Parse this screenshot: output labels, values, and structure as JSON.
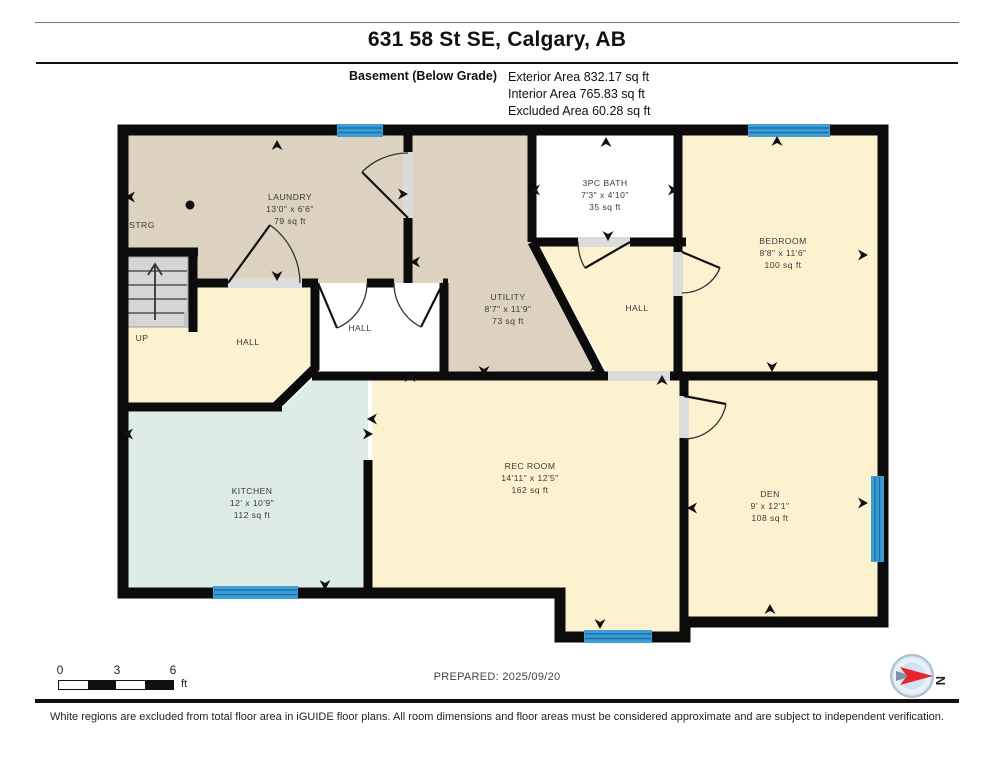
{
  "header": {
    "title": "631 58 St SE, Calgary, AB",
    "floor_label": "Basement (Below Grade)",
    "area_lines": [
      "Exterior Area 832.17 sq ft",
      "Interior Area 765.83 sq ft",
      "Excluded Area 60.28 sq ft"
    ]
  },
  "plan": {
    "rooms": [
      {
        "id": "laundry",
        "name": "LAUNDRY",
        "dims": "13'0\" x 6'6\"",
        "area": "79 sq ft"
      },
      {
        "id": "strg",
        "name": "STRG",
        "dims": "",
        "area": ""
      },
      {
        "id": "bath",
        "name": "3PC BATH",
        "dims": "7'3\" x 4'10\"",
        "area": "35 sq ft"
      },
      {
        "id": "bedroom",
        "name": "BEDROOM",
        "dims": "8'8\" x 11'6\"",
        "area": "100 sq ft"
      },
      {
        "id": "utility",
        "name": "UTILITY",
        "dims": "8'7\" x 11'9\"",
        "area": "73 sq ft"
      },
      {
        "id": "hall-west",
        "name": "HALL",
        "dims": "",
        "area": ""
      },
      {
        "id": "hall-middle",
        "name": "HALL",
        "dims": "",
        "area": ""
      },
      {
        "id": "hall-east",
        "name": "HALL",
        "dims": "",
        "area": ""
      },
      {
        "id": "up",
        "name": "UP",
        "dims": "",
        "area": ""
      },
      {
        "id": "kitchen",
        "name": "KITCHEN",
        "dims": "12' x 10'9\"",
        "area": "112 sq ft"
      },
      {
        "id": "rec-room",
        "name": "REC ROOM",
        "dims": "14'11\" x 12'5\"",
        "area": "162 sq ft"
      },
      {
        "id": "den",
        "name": "DEN",
        "dims": "9' x 12'1\"",
        "area": "108 sq ft"
      }
    ],
    "icons": {
      "pano_arrow": "➤",
      "pano_dot": "●",
      "stairs_up_arrow": "↑",
      "window": "▭",
      "door_swing": "◠"
    }
  },
  "footer": {
    "prepared": "PREPARED: 2025/09/20",
    "scale": {
      "ticks": [
        "0",
        "3",
        "6"
      ],
      "unit": "ft"
    },
    "compass_letter": "N",
    "disclaimer": "White regions are excluded from total floor area in iGUIDE floor plans. All room dimensions and floor areas must be considered approximate and are subject to independent verification."
  },
  "colors": {
    "wall": "#0b0b0b",
    "room_tan": "#ddd1c0",
    "room_cream": "#fcf2d0",
    "room_kitchen": "#ddece6",
    "excluded_white": "#ffffff",
    "stairs_gray": "#d5d5d5",
    "threshold_gray": "#dcdcdc",
    "window_blue": "#3d9ed6",
    "window_line": "#1d6fa3",
    "label_text": "#3a3a3a",
    "compass_face": "#cfe3f2",
    "compass_red": "#e8262a"
  }
}
